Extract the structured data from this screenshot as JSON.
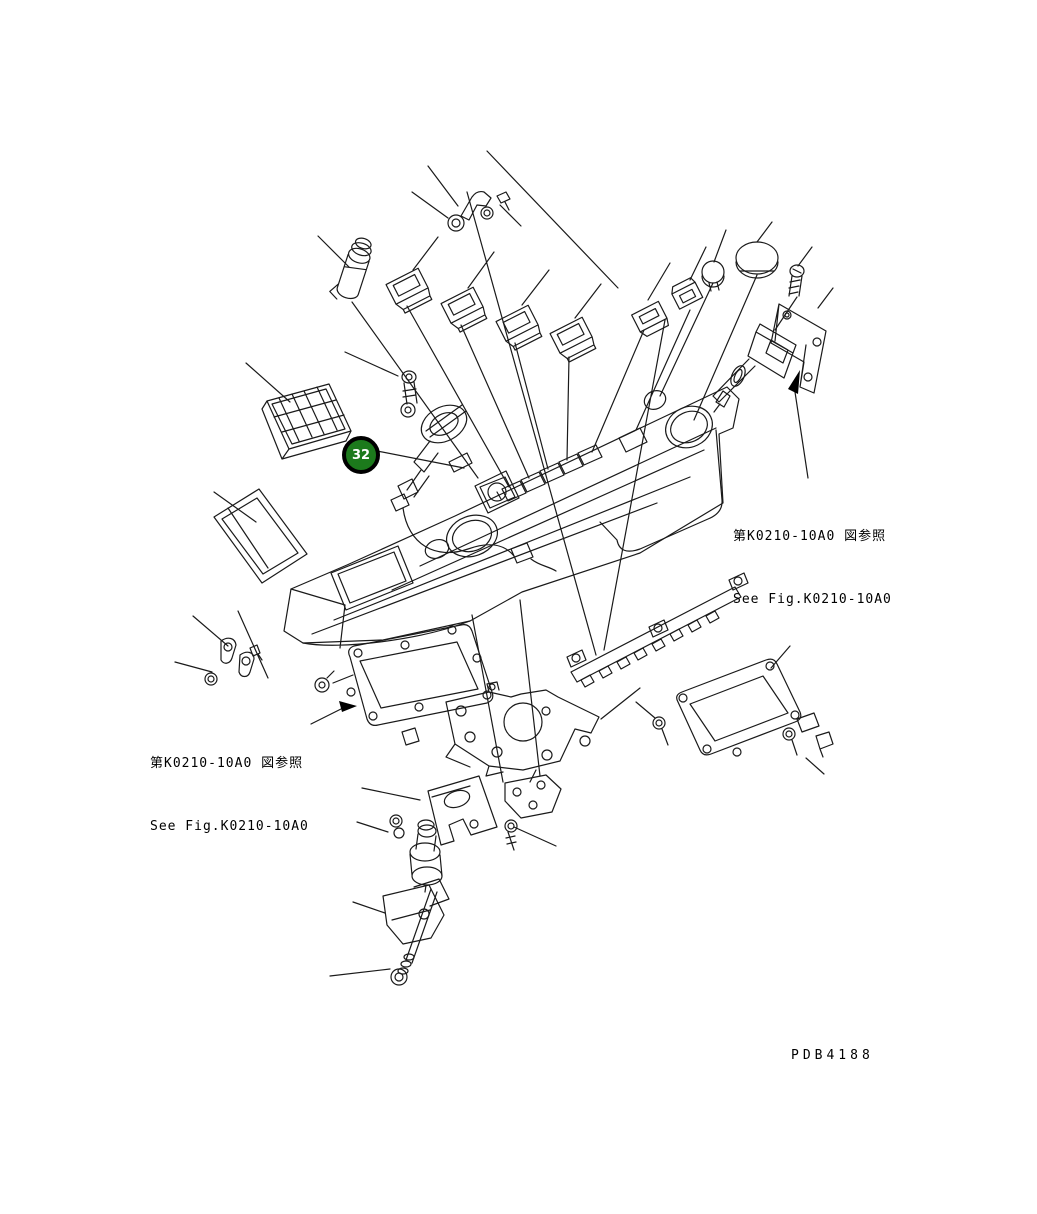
{
  "balloon": {
    "number": "32"
  },
  "reference_left": {
    "jp": "第K0210-10A0 図参照",
    "en": "See Fig.K0210-10A0"
  },
  "reference_right": {
    "jp": "第K0210-10A0 図参照",
    "en": "See Fig.K0210-10A0"
  },
  "drawing_code": "PDB4188",
  "colors": {
    "background": "#ffffff",
    "line": "#1a1a1a",
    "balloon_fill": "#1c7a1c",
    "balloon_ring": "#000000",
    "balloon_text": "#ffffff"
  }
}
